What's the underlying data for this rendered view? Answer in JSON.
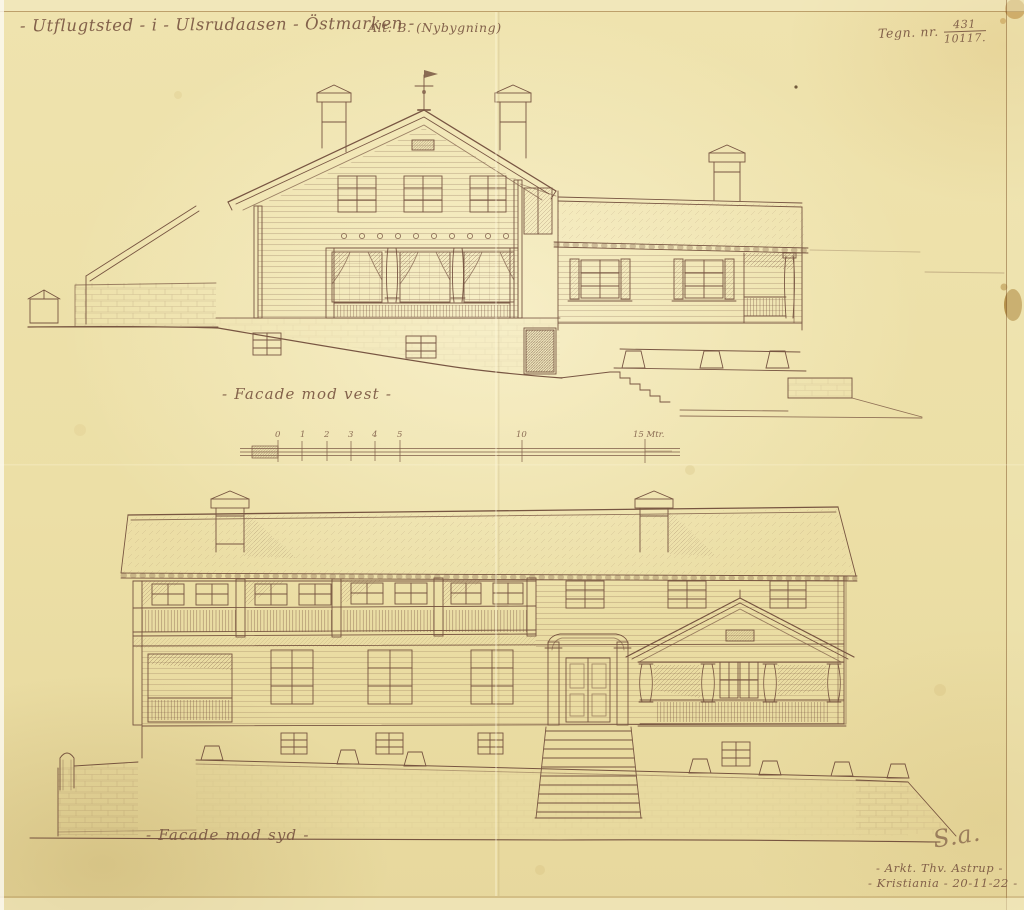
{
  "sheet": {
    "title": "- Utflugtsted - i - Ulsrudaasen - Östmarken -",
    "variant_note": "Alt: B. (Nybygning)",
    "drawing_no": {
      "label": "Tegn. nr.",
      "numerator": "431",
      "denominator": "10117."
    }
  },
  "drawings": {
    "west_elevation": {
      "caption": "- Facade mod vest -"
    },
    "south_elevation": {
      "caption": "- Facade mod syd -"
    }
  },
  "scale_bar": {
    "unit_ticks": [
      "0",
      "1",
      "2",
      "3",
      "4",
      "5",
      "10",
      "15 Mtr."
    ]
  },
  "signature": {
    "monogram": "S.a.",
    "architect_line": "- Arkt. Thv. Astrup -",
    "place_date_line": "- Kristiania - 20-11-22 -"
  },
  "colors": {
    "paper": "#ecdfa6",
    "ink": "#6b4636",
    "stain": "#b5812f"
  }
}
